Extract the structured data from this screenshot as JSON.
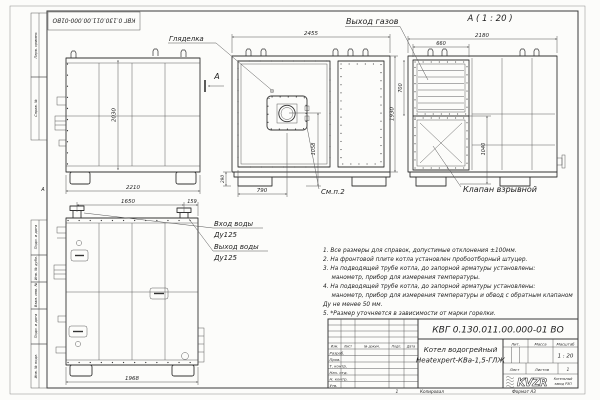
{
  "colors": {
    "paper": "#fcfcfa",
    "line": "#333333",
    "dim_line": "#555555",
    "text": "#1e1e1e"
  },
  "sheet": {
    "designation_top": "КВГ 0.130.011.00.000-01ВО",
    "margin_labels": [
      "Перв. примен.",
      "Справ. №",
      "Подп. и дата",
      "Инв. № дубл.",
      "Взам. инв. №",
      "Подп. и дата",
      "Инв. № подл."
    ],
    "zone_letter": "А"
  },
  "views": {
    "side": {
      "dim_height": "2030",
      "dim_width": "2210",
      "section_mark": "А"
    },
    "front": {
      "sight_glass": "Гляделка",
      "see_note": "См.п.2",
      "dim_width": "2455",
      "dim_height": "1930",
      "dim_burner": "1058",
      "dim_door": "790",
      "dim_base": "290"
    },
    "section_a": {
      "title": "А ( 1 : 20 )",
      "gas_outlet": "Выход газов",
      "explosion_valve": "Клапан взрывной",
      "dim_width": "2180",
      "dim_grille_w": "660",
      "dim_grille_h": "700",
      "dim_valve": "1040"
    },
    "rear": {
      "water_in": "Вход воды",
      "water_in_dn": "Ду125",
      "water_out": "Выход воды",
      "water_out_dn": "Ду125",
      "dim_span": "1650",
      "dim_offset": "159",
      "dim_width": "1968"
    }
  },
  "notes": [
    "1. Все размеры для справок, допустимые отклонения ±100мм.",
    "2. На фронтовой плите котла установлен пробоотборный штуцер.",
    "3. На подводящей трубе котла, до запорной арматуры установлены:",
    "манометр, прибор для измерения температуры.",
    "4. На подводящей трубе котла, до запорной арматуры установлены:",
    "манометр, прибор для измерения температуры и обвод с обратным клапаном",
    "Ду не менее 50 мм.",
    "5. *Размер уточняется в зависимости от марки горелки."
  ],
  "title_block": {
    "designation": "КВГ 0.130.011.00.000-01 ВО",
    "product_line1": "Котел водогрейный",
    "product_line2": "Heatexpert-КВа-1,5-ГЛЖ",
    "col_izm": "Изм.",
    "col_list": "Лист",
    "col_doc": "№ докум.",
    "col_podp": "Подп.",
    "col_data": "Дата",
    "rows": [
      "Разраб.",
      "Пров.",
      "Т. контр.",
      "Нач. отд.",
      "Н. контр.",
      "Утв."
    ],
    "lit_label": "Лит.",
    "mass_label": "Масса",
    "scale_label": "Масштаб",
    "scale_value": "1 : 20",
    "sheet_label": "Лист",
    "sheets_label": "Листов",
    "sheets_value": "1",
    "logo_text": "KVZR",
    "logo_caption_line1": "Котельный",
    "logo_caption_line2": "завод РЭП"
  },
  "footer": {
    "zone": "1",
    "copied": "Копировал",
    "format": "Формат А3"
  }
}
